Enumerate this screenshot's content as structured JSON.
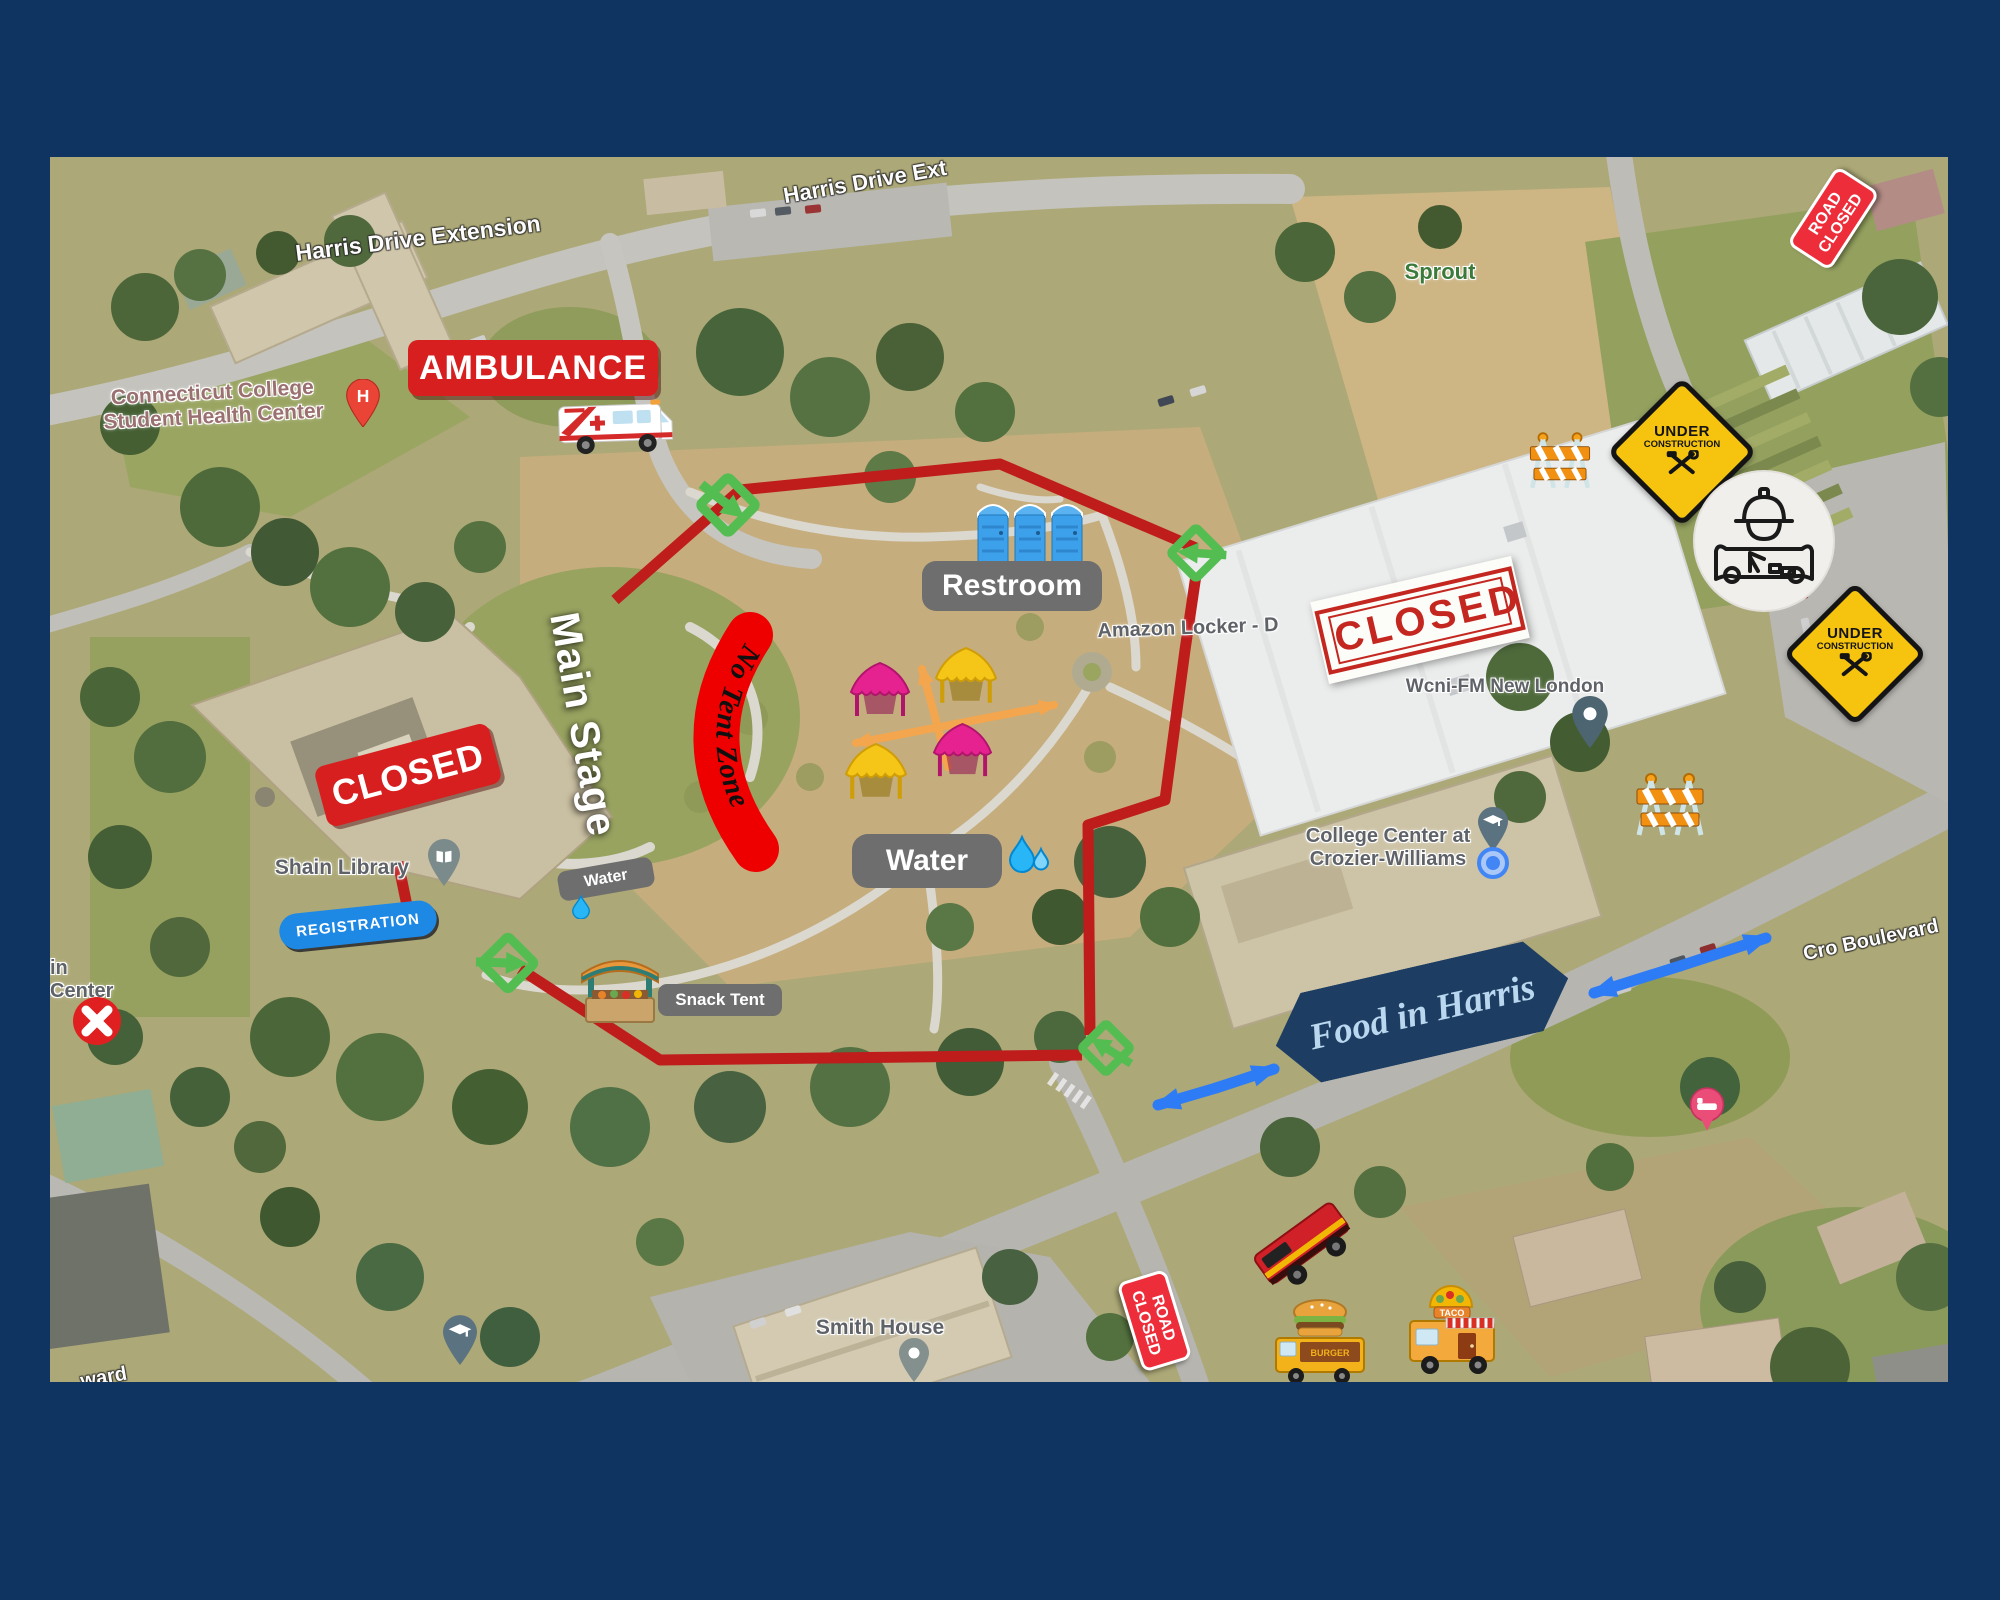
{
  "frame": {
    "border_color": "#103461"
  },
  "labels": {
    "harris_drive_1": "Harris Drive Extension",
    "harris_drive_2": "Harris Drive Ext",
    "health_center_1": "Connecticut College",
    "health_center_2": "Student Health Center",
    "h_pin": "H",
    "sprout": "Sprout",
    "amazon_locker": "Amazon Locker - D",
    "wcni": "Wcni-FM New London",
    "college_center_1": "College Center at",
    "college_center_2": "Crozier-Williams",
    "shain_library": "Shain Library",
    "smith_house": "Smith House",
    "cro_boulevard": "Cro Boulevard",
    "partial_center_1": "in",
    "partial_center_2": "Center",
    "partial_road": "ward"
  },
  "signs": {
    "ambulance": "AMBULANCE",
    "closed_building": "CLOSED",
    "closed_stamp": "CLOSED",
    "main_stage": "Main Stage",
    "no_tent_zone": "No Tent Zone",
    "registration": "REGISTRATION",
    "road_closed_line1": "ROAD",
    "road_closed_line2": "CLOSED",
    "under_construction_line1": "UNDER",
    "under_construction_line2": "CONSTRUCTION",
    "food_in_harris": "Food in Harris"
  },
  "pills": {
    "restroom": "Restroom",
    "water": "Water",
    "water_small": "Water",
    "snack_tent": "Snack Tent"
  },
  "trucks": {
    "burger": "BURGER",
    "taco": "TACO"
  },
  "colors": {
    "route_red": "#bf1c1c",
    "sign_red": "#d71f1f",
    "stamp_red": "#c4271f",
    "road_closed_red": "#ee2d3a",
    "no_tent_red": "#ee0000",
    "entry_green": "#54bd52",
    "registration_blue": "#1e88e5",
    "direction_blue": "#2e7bf6",
    "orange_arrow": "#f3a64d",
    "tent_pink": "#e5228f",
    "tent_yellow": "#f5c517",
    "pill_gray": "#6e6e6e",
    "banner_navy": "#1d3d63",
    "construction_yellow": "#f6c40e"
  }
}
